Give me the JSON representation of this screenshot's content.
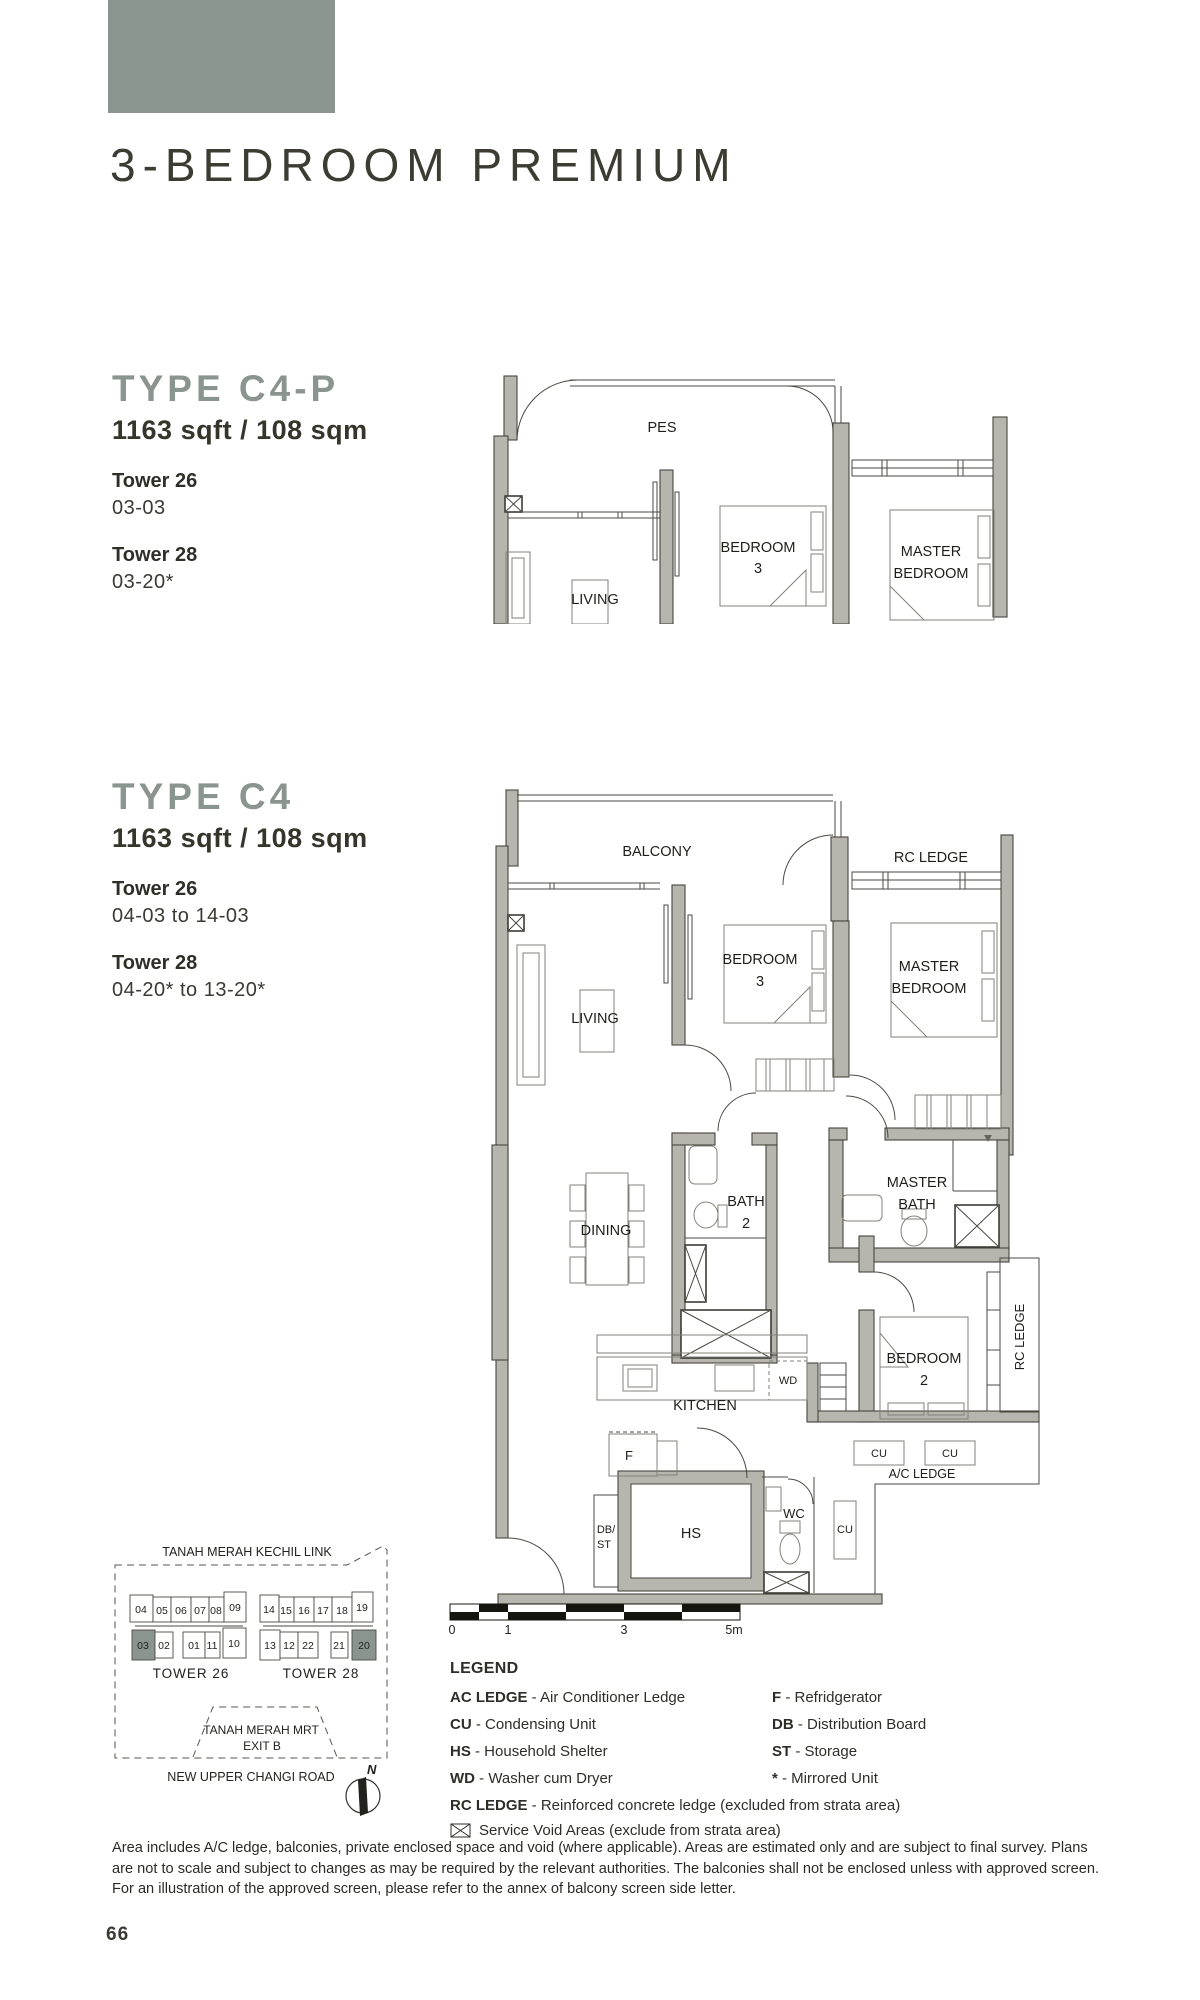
{
  "page": {
    "title": "3-BEDROOM PREMIUM",
    "page_number": "66"
  },
  "colors": {
    "accent": "#8b9590",
    "text_dark": "#35352c",
    "wall_gray": "#b6b6ae"
  },
  "unit_a": {
    "type_name": "TYPE C4-P",
    "area": "1163 sqft / 108 sqm",
    "towers": [
      {
        "name": "Tower 26",
        "units": "03-03"
      },
      {
        "name": "Tower 28",
        "units": "03-20*"
      }
    ]
  },
  "unit_b": {
    "type_name": "TYPE C4",
    "area": "1163 sqft / 108 sqm",
    "towers": [
      {
        "name": "Tower 26",
        "units": "04-03 to 14-03"
      },
      {
        "name": "Tower 28",
        "units": "04-20* to 13-20*"
      }
    ]
  },
  "plan_a": {
    "labels": {
      "pes": "PES",
      "living": "LIVING",
      "bedroom3_1": "BEDROOM",
      "bedroom3_2": "3",
      "master_1": "MASTER",
      "master_2": "BEDROOM"
    }
  },
  "plan_b": {
    "labels": {
      "balcony": "BALCONY",
      "rc_ledge_top": "RC LEDGE",
      "living": "LIVING",
      "bedroom3_1": "BEDROOM",
      "bedroom3_2": "3",
      "master_1": "MASTER",
      "master_2": "BEDROOM",
      "dining": "DINING",
      "bath2_1": "BATH",
      "bath2_2": "2",
      "master_bath_1": "MASTER",
      "master_bath_2": "BATH",
      "bedroom2_1": "BEDROOM",
      "bedroom2_2": "2",
      "rc_ledge_right": "RC LEDGE",
      "kitchen": "KITCHEN",
      "wd": "WD",
      "fridge": "F",
      "db": "DB/",
      "st": "ST",
      "hs": "HS",
      "wc": "WC",
      "cu1": "CU",
      "cu2": "CU",
      "cu3": "CU",
      "ac_ledge": "A/C LEDGE"
    }
  },
  "scale_bar": {
    "t0": "0",
    "t1": "1",
    "t3": "3",
    "t5": "5m"
  },
  "site_map": {
    "road_top": "TANAH MERAH KECHIL LINK",
    "mrt_line1": "TANAH MERAH MRT",
    "mrt_line2": "EXIT B",
    "road_bottom": "NEW UPPER CHANGI ROAD",
    "compass": "N",
    "tower26": {
      "label": "TOWER 26",
      "top_row": [
        "04",
        "05",
        "06",
        "07",
        "08",
        "09"
      ],
      "bottom_row": [
        "03",
        "02",
        "01",
        "11",
        "10"
      ],
      "highlighted_unit": "03"
    },
    "tower28": {
      "label": "TOWER 28",
      "top_row": [
        "14",
        "15",
        "16",
        "17",
        "18",
        "19"
      ],
      "bottom_row": [
        "13",
        "12",
        "22",
        "21",
        "20"
      ],
      "highlighted_unit": "20"
    }
  },
  "legend": {
    "title": "LEGEND",
    "col1": [
      {
        "abbr": "AC LEDGE",
        "rest": " - Air Conditioner Ledge"
      },
      {
        "abbr": "CU",
        "rest": " - Condensing Unit"
      },
      {
        "abbr": "HS",
        "rest": " - Household Shelter"
      },
      {
        "abbr": "WD",
        "rest": " - Washer cum Dryer"
      }
    ],
    "col2": [
      {
        "abbr": "F",
        "rest": " - Refridgerator"
      },
      {
        "abbr": "DB",
        "rest": " - Distribution Board"
      },
      {
        "abbr": "ST",
        "rest": " - Storage"
      },
      {
        "abbr": "*",
        "rest": " - Mirrored Unit"
      }
    ],
    "rc_row": {
      "abbr": "RC LEDGE",
      "rest": " - Reinforced concrete ledge (excluded from strata area)"
    },
    "void_row": "Service Void Areas (exclude from strata area)"
  },
  "disclaimer": "Area includes A/C ledge, balconies, private enclosed space and void (where applicable). Areas are estimated only and are subject to final survey. Plans are not to scale and subject to changes as may be required by the relevant authorities. The balconies shall not be enclosed unless with approved screen. For an illustration of the approved screen, please refer to the annex of balcony screen side letter."
}
